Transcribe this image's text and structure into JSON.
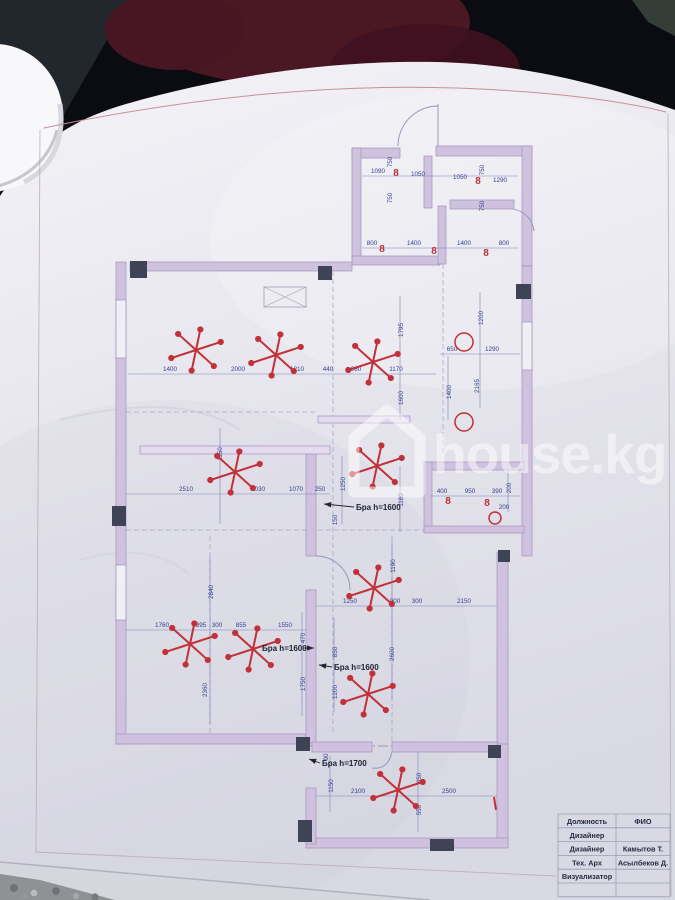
{
  "photo": {
    "watermark_text": "house.kg",
    "watermark_icon": "house-outline-icon",
    "background": {
      "fabric_dark": "#0a0c11",
      "fabric_maroon": "#4a1723",
      "gravel": "#8f9194"
    }
  },
  "colors": {
    "wall": "#cfc2de",
    "wall_light": "#e4dcee",
    "column": "#3e4356",
    "dim_text": "#333f8f",
    "dim_line": "#7b84b8",
    "red": "#c23038",
    "frame_pink": "#c79098",
    "paper": "#e9e8ef"
  },
  "plan": {
    "dims": [
      {
        "t": "1090",
        "x": 378,
        "y": 173
      },
      {
        "t": "1050",
        "x": 418,
        "y": 176
      },
      {
        "t": "1050",
        "x": 460,
        "y": 179
      },
      {
        "t": "1290",
        "x": 500,
        "y": 182
      },
      {
        "t": "750",
        "x": 392,
        "y": 162,
        "v": 1
      },
      {
        "t": "750",
        "x": 392,
        "y": 198,
        "v": 1
      },
      {
        "t": "750",
        "x": 484,
        "y": 170,
        "v": 1
      },
      {
        "t": "750",
        "x": 484,
        "y": 206,
        "v": 1
      },
      {
        "t": "800",
        "x": 372,
        "y": 245
      },
      {
        "t": "1400",
        "x": 414,
        "y": 245
      },
      {
        "t": "1400",
        "x": 464,
        "y": 245
      },
      {
        "t": "800",
        "x": 504,
        "y": 245
      },
      {
        "t": "1400",
        "x": 170,
        "y": 371
      },
      {
        "t": "2000",
        "x": 238,
        "y": 371
      },
      {
        "t": "1210",
        "x": 297,
        "y": 371
      },
      {
        "t": "440",
        "x": 328,
        "y": 371
      },
      {
        "t": "980",
        "x": 356,
        "y": 371
      },
      {
        "t": "1170",
        "x": 396,
        "y": 371
      },
      {
        "t": "1795",
        "x": 403,
        "y": 330,
        "v": 1
      },
      {
        "t": "1600",
        "x": 403,
        "y": 398,
        "v": 1
      },
      {
        "t": "1400",
        "x": 451,
        "y": 392,
        "v": 1
      },
      {
        "t": "650",
        "x": 452,
        "y": 351
      },
      {
        "t": "1290",
        "x": 492,
        "y": 351
      },
      {
        "t": "1200",
        "x": 483,
        "y": 318,
        "v": 1
      },
      {
        "t": "2165",
        "x": 479,
        "y": 386,
        "v": 1
      },
      {
        "t": "2510",
        "x": 186,
        "y": 491
      },
      {
        "t": "1030",
        "x": 258,
        "y": 491
      },
      {
        "t": "1070",
        "x": 296,
        "y": 491
      },
      {
        "t": "250",
        "x": 320,
        "y": 491
      },
      {
        "t": "1150",
        "x": 222,
        "y": 454,
        "v": 1
      },
      {
        "t": "1250",
        "x": 345,
        "y": 484,
        "v": 1
      },
      {
        "t": "1180",
        "x": 403,
        "y": 500,
        "v": 1
      },
      {
        "t": "150",
        "x": 337,
        "y": 520,
        "v": 1
      },
      {
        "t": "400",
        "x": 442,
        "y": 493
      },
      {
        "t": "950",
        "x": 470,
        "y": 493
      },
      {
        "t": "390",
        "x": 497,
        "y": 493
      },
      {
        "t": "200",
        "x": 511,
        "y": 488,
        "v": 1
      },
      {
        "t": "200",
        "x": 504,
        "y": 509
      },
      {
        "t": "1760",
        "x": 162,
        "y": 627
      },
      {
        "t": "395",
        "x": 201,
        "y": 627
      },
      {
        "t": "300",
        "x": 217,
        "y": 627
      },
      {
        "t": "855",
        "x": 241,
        "y": 627
      },
      {
        "t": "1550",
        "x": 285,
        "y": 627
      },
      {
        "t": "470",
        "x": 305,
        "y": 638,
        "v": 1
      },
      {
        "t": "2840",
        "x": 213,
        "y": 592,
        "v": 1
      },
      {
        "t": "2360",
        "x": 207,
        "y": 690,
        "v": 1
      },
      {
        "t": "1750",
        "x": 305,
        "y": 684,
        "v": 1
      },
      {
        "t": "1250",
        "x": 350,
        "y": 603
      },
      {
        "t": "900",
        "x": 395,
        "y": 603
      },
      {
        "t": "300",
        "x": 417,
        "y": 603
      },
      {
        "t": "2150",
        "x": 464,
        "y": 603
      },
      {
        "t": "1190",
        "x": 395,
        "y": 566,
        "v": 1
      },
      {
        "t": "2600",
        "x": 394,
        "y": 654,
        "v": 1
      },
      {
        "t": "850",
        "x": 337,
        "y": 652,
        "v": 1
      },
      {
        "t": "1200",
        "x": 337,
        "y": 692,
        "v": 1
      },
      {
        "t": "2100",
        "x": 358,
        "y": 793
      },
      {
        "t": "2500",
        "x": 449,
        "y": 793
      },
      {
        "t": "650",
        "x": 421,
        "y": 778,
        "v": 1
      },
      {
        "t": "1150",
        "x": 333,
        "y": 786,
        "v": 1
      },
      {
        "t": "550",
        "x": 421,
        "y": 810,
        "v": 1
      },
      {
        "t": "90",
        "x": 328,
        "y": 757,
        "v": 1
      }
    ],
    "chandeliers": [
      {
        "x": 196,
        "y": 350
      },
      {
        "x": 276,
        "y": 355
      },
      {
        "x": 373,
        "y": 362
      },
      {
        "x": 235,
        "y": 472
      },
      {
        "x": 377,
        "y": 466
      },
      {
        "x": 374,
        "y": 588
      },
      {
        "x": 190,
        "y": 644
      },
      {
        "x": 253,
        "y": 649
      },
      {
        "x": 368,
        "y": 694
      },
      {
        "x": 398,
        "y": 790
      }
    ],
    "spot_label": "8",
    "spots": [
      {
        "x": 396,
        "y": 176
      },
      {
        "x": 478,
        "y": 184
      },
      {
        "x": 382,
        "y": 252
      },
      {
        "x": 434,
        "y": 254
      },
      {
        "x": 486,
        "y": 256
      },
      {
        "x": 448,
        "y": 504
      },
      {
        "x": 487,
        "y": 506
      }
    ],
    "circle_lights": [
      {
        "x": 464,
        "y": 342,
        "r": 9
      },
      {
        "x": 464,
        "y": 422,
        "r": 9
      },
      {
        "x": 495,
        "y": 518,
        "r": 6
      }
    ],
    "bra_labels": [
      {
        "t": "Бра h=1600",
        "x": 356,
        "y": 510,
        "line": [
          354,
          507,
          324,
          504
        ]
      },
      {
        "t": "Бра h=1600",
        "x": 262,
        "y": 651,
        "line": [
          304,
          648,
          314,
          648
        ]
      },
      {
        "t": "Бра h=1600",
        "x": 334,
        "y": 670,
        "line": [
          332,
          667,
          319,
          665
        ]
      },
      {
        "t": "Бра h=1700",
        "x": 322,
        "y": 766,
        "line": [
          320,
          763,
          309,
          759
        ]
      }
    ],
    "wall_mark_red": {
      "x": 494,
      "y1": 797,
      "y2": 810
    }
  },
  "title_block": {
    "col_headers": [
      "Должность",
      "ФИО"
    ],
    "rows": [
      {
        "role": "Дизайнер",
        "name": ""
      },
      {
        "role": "Дизайнер",
        "name": "Камытов Т."
      },
      {
        "role": "Тех. Арх",
        "name": "Асылбеков Д."
      },
      {
        "role": "Визуализатор",
        "name": ""
      },
      {
        "role": "",
        "name": ""
      }
    ]
  }
}
